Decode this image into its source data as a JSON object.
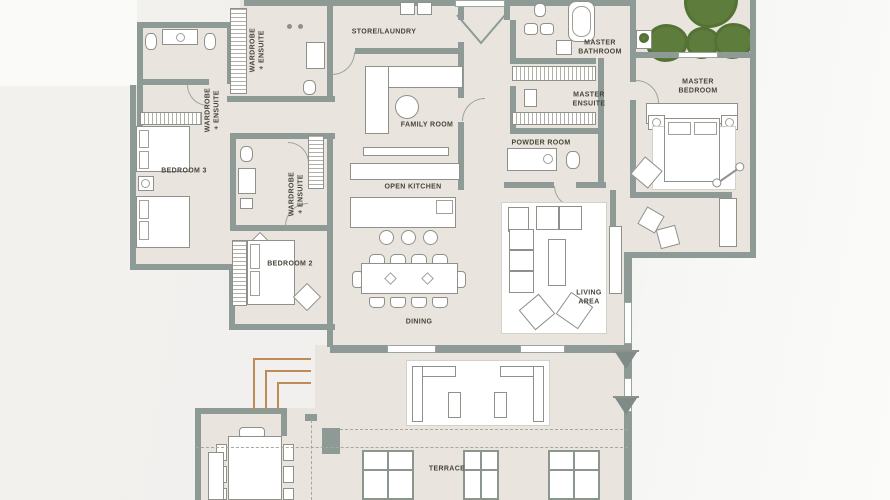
{
  "plan": {
    "type": "apartment-floor-plan",
    "rooms": [
      {
        "id": "wardrobe-ensuite-left",
        "label": "WARDROBE\n+ ENSUITE",
        "orientation": "vertical"
      },
      {
        "id": "wardrobe-ensuite-top",
        "label": "WARDROBE\n+ ENSUITE",
        "orientation": "vertical"
      },
      {
        "id": "wardrobe-ensuite-mid",
        "label": "WARDROBE\n+ ENSUITE",
        "orientation": "vertical"
      },
      {
        "id": "store-laundry",
        "label": "STORE/LAUNDRY",
        "orientation": "horizontal"
      },
      {
        "id": "master-bathroom",
        "label": "MASTER\nBATHROOM",
        "orientation": "horizontal"
      },
      {
        "id": "master-ensuite",
        "label": "MASTER\nENSUITE",
        "orientation": "horizontal"
      },
      {
        "id": "master-bedroom",
        "label": "MASTER\nBEDROOM",
        "orientation": "horizontal"
      },
      {
        "id": "family-room",
        "label": "FAMILY ROOM",
        "orientation": "horizontal"
      },
      {
        "id": "powder-room",
        "label": "POWDER ROOM",
        "orientation": "horizontal"
      },
      {
        "id": "bedroom-3",
        "label": "BEDROOM 3",
        "orientation": "horizontal"
      },
      {
        "id": "open-kitchen",
        "label": "OPEN KITCHEN",
        "orientation": "horizontal"
      },
      {
        "id": "bedroom-2",
        "label": "BEDROOM 2",
        "orientation": "horizontal"
      },
      {
        "id": "living-area",
        "label": "LIVING\nAREA",
        "orientation": "horizontal"
      },
      {
        "id": "dining",
        "label": "DINING",
        "orientation": "horizontal"
      },
      {
        "id": "terrace",
        "label": "TERRACE",
        "orientation": "horizontal"
      }
    ],
    "colors": {
      "background": "#f2f1ee",
      "floor": "#e9e5de",
      "wall": "#8d9a95",
      "furniture_outline": "#90908a",
      "label_text": "#45443b",
      "tree_green": "#5e7d3d",
      "accent_orange": "#bd8a58"
    }
  }
}
